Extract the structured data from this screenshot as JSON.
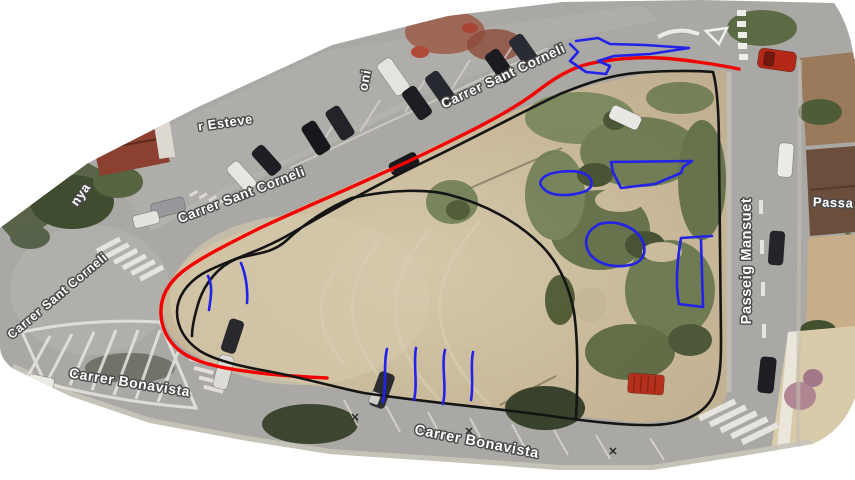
{
  "map": {
    "background_color": "#ffffff",
    "street_labels": [
      {
        "id": "esteve-fragment",
        "text": "r Esteve"
      },
      {
        "id": "nya-fragment",
        "text": "nya"
      },
      {
        "id": "sant-corneli-west",
        "text": "Carrer Sant Corneli"
      },
      {
        "id": "sant-corneli-mid",
        "text": "Carrer Sant Corneli"
      },
      {
        "id": "sant-corneli-top",
        "text": "Carrer Sant Corneli"
      },
      {
        "id": "antoni-fragment",
        "text": "oni"
      },
      {
        "id": "bonavista-west",
        "text": "Carrer Bonavista"
      },
      {
        "id": "bonavista-south",
        "text": "Carrer Bonavista"
      },
      {
        "id": "passeig-mansuet",
        "text": "Passeig Mansuet"
      },
      {
        "id": "passa-fragment",
        "text": "Passa"
      }
    ],
    "annotations": {
      "red_boundary": {
        "color": "#f40000"
      },
      "black_outline": {
        "color": "#151515"
      },
      "blue_marks": {
        "color": "#2222e8"
      }
    }
  }
}
